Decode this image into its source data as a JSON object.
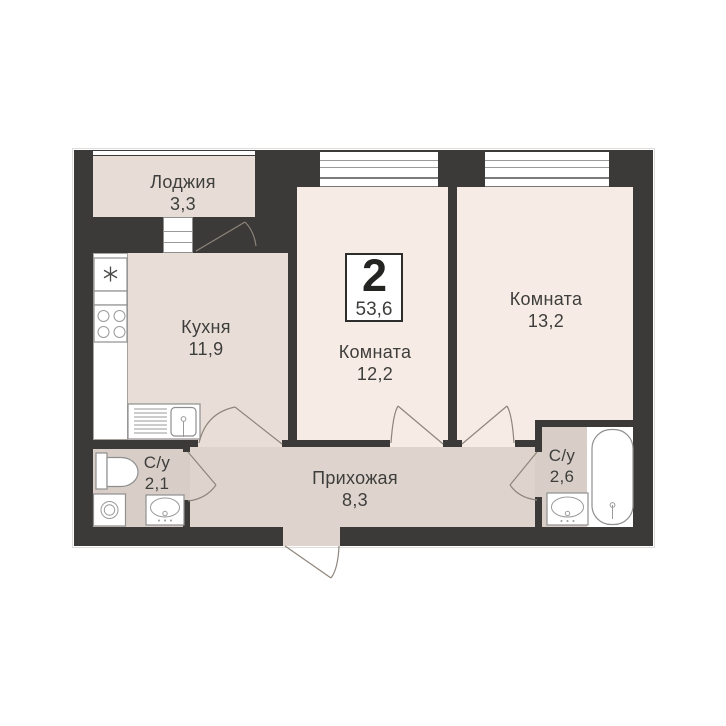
{
  "plan": {
    "badge": {
      "rooms_count": "2",
      "total_area": "53,6"
    },
    "rooms": [
      {
        "name": "Лоджия",
        "area": "3,3"
      },
      {
        "name": "Кухня",
        "area": "11,9"
      },
      {
        "name": "Комната",
        "area": "12,2"
      },
      {
        "name": "Комната",
        "area": "13,2"
      },
      {
        "name": "Прихожая",
        "area": "8,3"
      },
      {
        "name": "С/у",
        "area": "2,1"
      },
      {
        "name": "С/у",
        "area": "2,6"
      }
    ],
    "colors": {
      "wall": "#3b3a38",
      "room": "#f7ebe5",
      "kitchen": "#e9ded7",
      "loggia": "#e7ddd6",
      "hallway": "#ded4cd",
      "bathroom": "#d8cec7",
      "fixture-outline": "#8f8f8f",
      "door-line": "#8e857c",
      "text": "#3e3e3c"
    }
  }
}
